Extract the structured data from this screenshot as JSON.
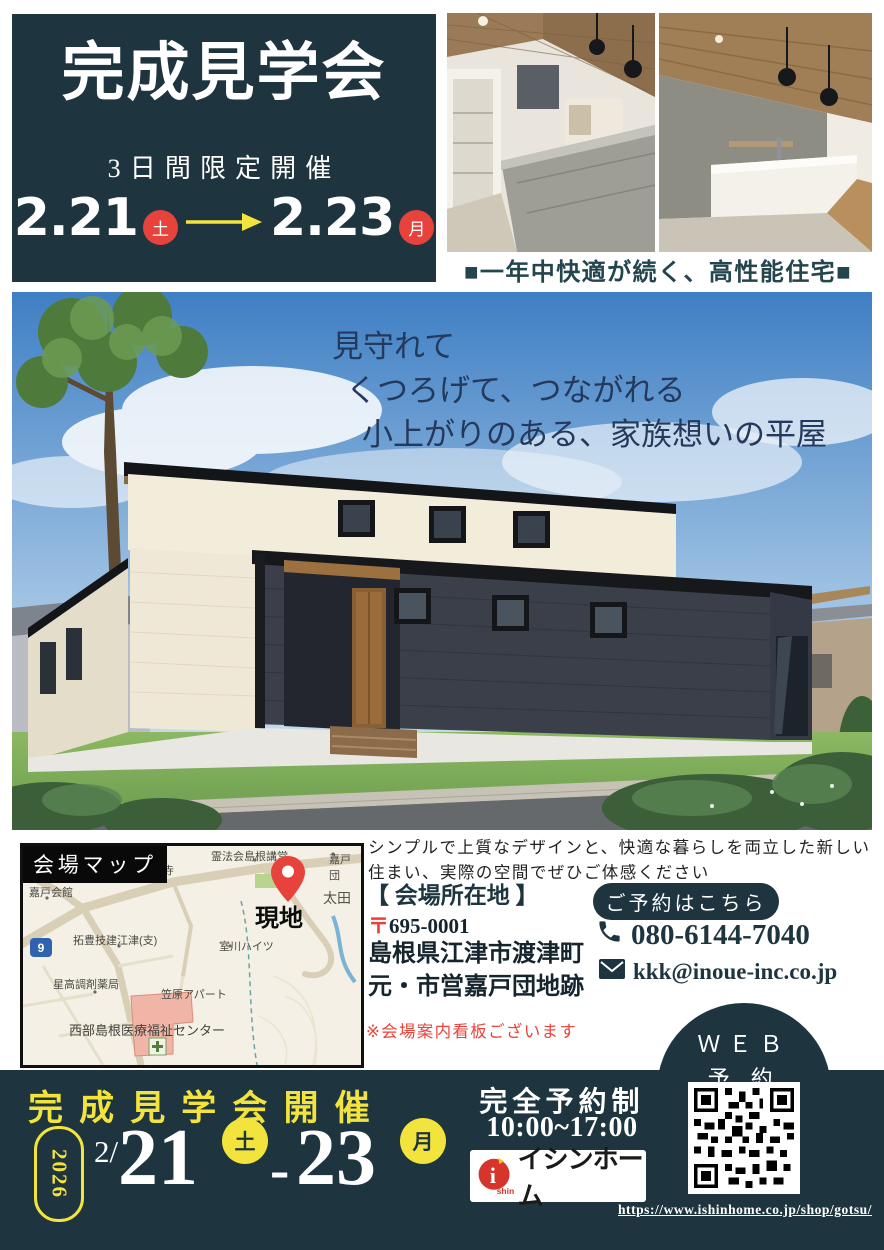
{
  "colors": {
    "navy": "#1e3540",
    "red": "#e8423c",
    "yellow": "#f2e43c",
    "teal_caption": "#23454d",
    "note_red": "#e8433c",
    "map_bg": "#f4f0e5"
  },
  "icons": {
    "phone-icon": "handset",
    "mail-icon": "envelope",
    "map-pin-icon": "location pin",
    "arrow-right-icon": "→",
    "qr-code": "qr"
  },
  "hero": {
    "title": "完成見学会",
    "subtitle": "3日間限定開催",
    "date_start": "2.21",
    "week_start": "土",
    "date_end": "2.23",
    "week_end": "月"
  },
  "photos": {
    "caption": "■一年中快適が続く、高性能住宅■"
  },
  "render": {
    "headline": [
      "見守れて",
      "くつろげて、つながれる",
      "小上がりのある、家族想いの平屋"
    ]
  },
  "lead": {
    "line1": "シンプルで上質なデザインと、快適な暮らしを両立した新しい",
    "line2": "住まい、実際の空間でぜひご体感ください"
  },
  "venue": {
    "heading": "【 会場所在地 】",
    "postal_mark": "〒",
    "postal_code": "695-0001",
    "address1": "島根県江津市渡津町",
    "address2": "元・市営嘉戸団地跡",
    "note": "※会場案内看板ございます"
  },
  "contact": {
    "reserve_badge": "ご予約はこちら",
    "phone": "080-6144-7040",
    "email": "kkk@inoue-inc.co.jp",
    "web_line1": "ＷＥＢ",
    "web_line2": "予 約"
  },
  "map": {
    "badge": "会場マップ",
    "site": "現地",
    "route": "9",
    "labels": [
      "長徳寺",
      "霊法会島根講堂",
      "嘉戸団",
      "嘉戸会館",
      "太田",
      "拓豊技建江津(支)",
      "室川ハイツ",
      "笠原アパート",
      "星高調剤薬局",
      "西部島根医療福祉センター"
    ]
  },
  "footer": {
    "heading": "完成見学会開催",
    "year": "2026",
    "month": "2/",
    "day_start": "21",
    "week_start": "土",
    "sep": "-",
    "day_end": "23",
    "week_end": "月",
    "reservation": "完全予約制",
    "hours": "10:00~17:00",
    "brand_mark": "i",
    "brand_mark_sub": "shin",
    "brand_name": "イシンホーム",
    "url": "https://www.ishinhome.co.jp/shop/gotsu/"
  }
}
